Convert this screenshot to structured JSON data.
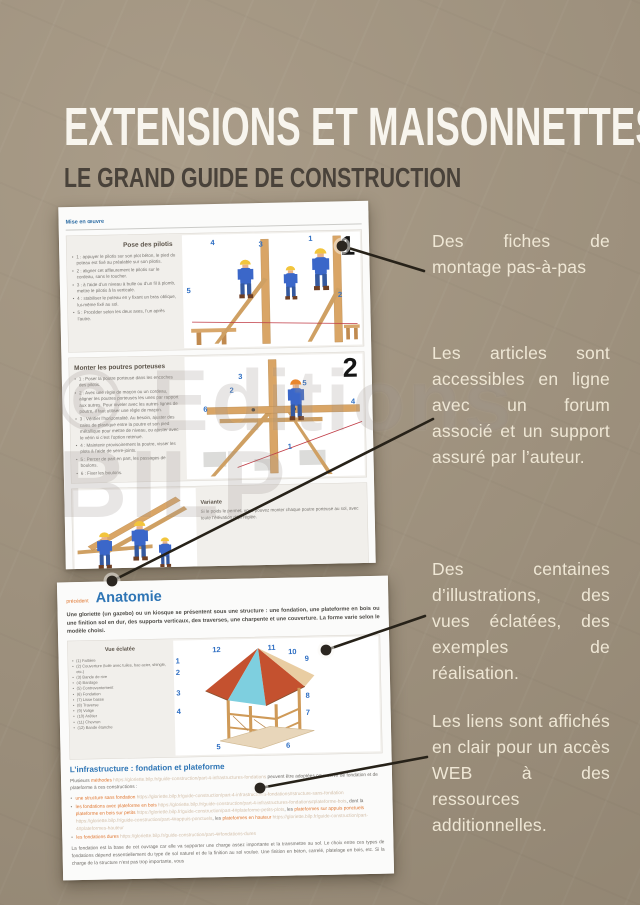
{
  "page": {
    "title": "EXTENSIONS ET MAISONNETTES",
    "subtitle": "LE GRAND GUIDE DE CONSTRUCTION",
    "watermark_line1": "© Editions",
    "watermark_line2": "BILP",
    "colors": {
      "background": "#a49681",
      "title": "#f8f5ee",
      "subtitle": "#49423a",
      "annotation_text": "#efe7d5",
      "callout_line": "#272219",
      "accent_blue": "#2e75b5",
      "accent_orange": "#e0762f",
      "url_light": "#d3bfa9",
      "figure_number_blue": "#2f6fc3"
    }
  },
  "annotations": [
    "Des fiches de montage pas-à-pas",
    "Les articles sont accessibles en ligne avec un forum associé et un support assuré par l’auteur.",
    "Des centaines d’illustrations, des vues éclatées, des exemples de réalisation.",
    "Les liens sont affichés en clair pour un accès WEB à des ressources additionnelles."
  ],
  "screenshot1": {
    "nav_link": "Mise en œuvre",
    "step1": {
      "heading": "Pose des pilotis",
      "big_number": "1",
      "figure_numbers": [
        "4",
        "3",
        "1",
        "5",
        "2"
      ],
      "bullets": [
        "1 : appuyer le pilotis sur son plot béton, le pied du poteau est fixé au préalable sur son pilotis.",
        "2 : aligner cet affleurement le pilotis sur le cordeau, sans le toucher.",
        "3 : à l’aide d’un niveau à bulle ou d’un fil à plomb, mettre le pilotis à la verticale.",
        "4 : stabiliser le poteau en y fixant un bras oblique, lui-même fixé au sol.",
        "5 : Procéder selon les deux axes, l’un après l’autre."
      ]
    },
    "step2": {
      "heading": "Monter les poutres porteuses",
      "big_number": "2",
      "figure_numbers": [
        "3",
        "2",
        "5",
        "6",
        "4",
        "1"
      ],
      "bullets": [
        "1 : Poser la poutre porteuse dans les encoches des pilotis.",
        "2 : Avec une règle de maçon ou un cordeau, aligner les poutres porteuses les unes par rapport aux autres. Pour niveler avec les autres lignes de poutre, il faut utiliser une règle de maçon.",
        "3 : Vérifier l’horizontalité. Au besoin, ajuster des cales de plastique entre la poutre et son pied métallique pour mettre de niveau, ou ajuster avec le vérin si c’est l’option retenue.",
        "4 : Maintenir provisoirement la poutre, visser les plots à l’aide de serre-joints.",
        "5 : Percer de part en part, les passages de boulons.",
        "6 : Fixer les boulons."
      ]
    },
    "variante": {
      "heading": "Variante",
      "text": "Si le poids le permet, vous pouvez monter chaque poutre porteuse au sol, avec toute l’élévation déjà réglée."
    }
  },
  "screenshot2": {
    "kicker": "précédent",
    "title": "Anatomie",
    "intro": "Une gloriette (un gazebo) ou un kiosque se présentent sous une structure : une fondation, une plateforme en bois ou une finition sol en dur, des supports verticaux, des traverses, une charpente et une couverture. La forme varie selon le modèle choisi.",
    "exploded": {
      "heading": "Vue éclatée",
      "figure_numbers": [
        "1",
        "2",
        "3",
        "4",
        "5",
        "6",
        "7",
        "8",
        "9",
        "10",
        "11",
        "12"
      ],
      "items": [
        "(1) Faîtière",
        "(2) Couverture (toile avec tuiles, bac acier, shingle, etc.)",
        "(3) Bande de rive",
        "(4) Bardage",
        "(5) Contreventement",
        "(6) Fondation",
        "(7) Lisse basse",
        "(8) Traverse",
        "(9) Volige",
        "(10) Arêtier",
        "(11) Chevron",
        "(12) Bande étanche"
      ]
    },
    "infrastructure": {
      "heading": "L’infrastructure : fondation et plateforme",
      "intro_segments": [
        {
          "kind": "plain",
          "t": "Plusieurs "
        },
        {
          "kind": "link",
          "t": "méthodes"
        },
        {
          "kind": "url",
          "t": " https://gloriette.bilp.fr/guide-construction/part-4-infrastructures-fondations"
        },
        {
          "kind": "plain",
          "t": " peuvent être adoptées pour servir de fondation et de plateforme à ces constructions :"
        }
      ],
      "bullets": [
        {
          "segments": [
            {
              "kind": "link",
              "t": "une structure sans fondation"
            },
            {
              "kind": "url",
              "t": " https://gloriette.bilp.fr/guide-construction/part-4-infrastructures-fondations#structure-sans-fondation"
            }
          ]
        },
        {
          "segments": [
            {
              "kind": "link",
              "t": "les fondations avec plateforme en bois"
            },
            {
              "kind": "url",
              "t": " https://gloriette.bilp.fr/guide-construction/part-4-infrastructures-fondations#plateforme-bois"
            },
            {
              "kind": "plain",
              "t": ", dont la "
            },
            {
              "kind": "link",
              "t": "plateforme en bois sur petits"
            },
            {
              "kind": "url",
              "t": " https://gloriette.bilp.fr/guide-construction/part-4#plateforme-petits-plots"
            },
            {
              "kind": "plain",
              "t": ", les "
            },
            {
              "kind": "link",
              "t": "plateformes sur appuis ponctuels"
            },
            {
              "kind": "url",
              "t": " https://gloriette.bilp.fr/guide-construction/part-4#appuis-ponctuels"
            },
            {
              "kind": "plain",
              "t": ", les "
            },
            {
              "kind": "link",
              "t": "plateformes en hauteur"
            },
            {
              "kind": "url",
              "t": " https://gloriette.bilp.fr/guide-construction/part-4#plateformes-hauteur"
            }
          ]
        },
        {
          "segments": [
            {
              "kind": "link",
              "t": "les fondations dures"
            },
            {
              "kind": "url",
              "t": " https://gloriette.bilp.fr/guide-construction/part-4#fondations-dures"
            }
          ]
        }
      ],
      "footer_paragraph": "La fondation est la base de cet ouvrage car elle va supporter une charge assez importante et la transmettre au sol. Le choix entre ces types de fondations dépend essentiellement du type de sol naturel et de la finition au sol voulue. Une finition en béton, carrelé, platelage en bois, etc. Si la charge de la structure n’est pas trop importante, vous"
    }
  }
}
